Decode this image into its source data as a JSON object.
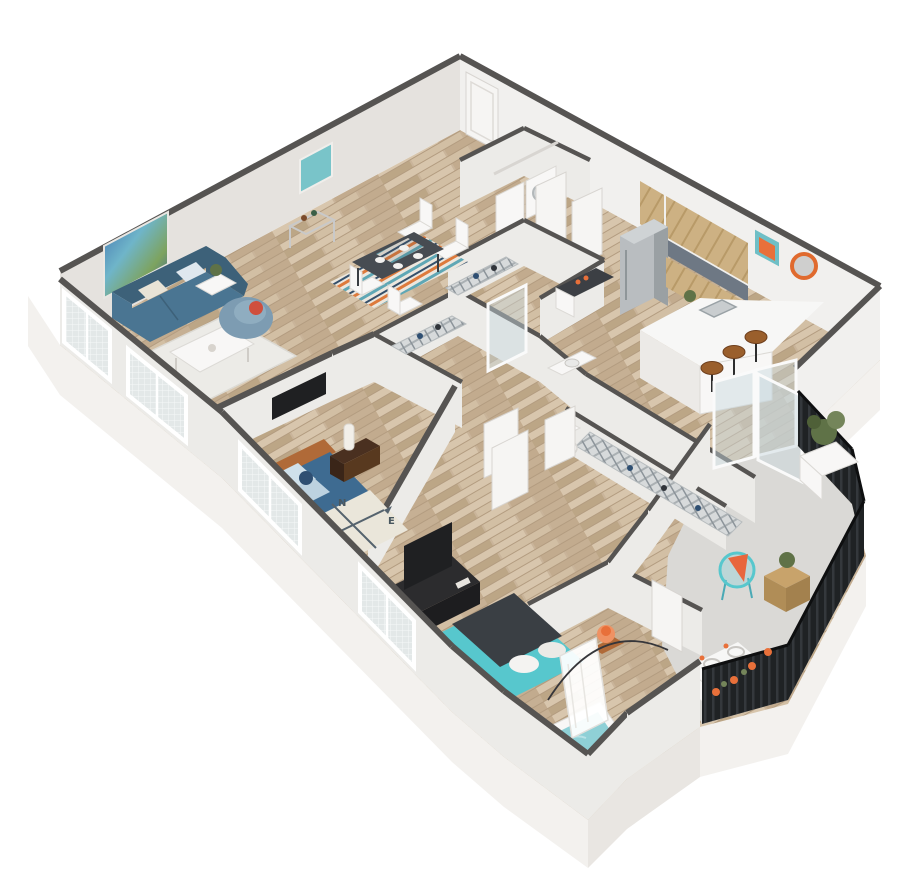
{
  "scene": {
    "type": "3d-isometric-floor-plan",
    "description": "Two-bedroom, two-bathroom apartment floor plan rendered in 3D cutaway perspective with private balcony",
    "compass_blanket": {
      "n": "N",
      "e": "E",
      "s": "S",
      "w": "W"
    },
    "rooms": [
      {
        "id": "living-room",
        "name": "Living Room",
        "furniture": [
          "blue sofa with pillows",
          "white coffee table",
          "blue armchair with red pillow",
          "two ottomans",
          "two side tables with plants",
          "abstract wall art",
          "white area rug"
        ]
      },
      {
        "id": "dining-area",
        "name": "Dining Area",
        "furniture": [
          "dark dining table",
          "four white chairs",
          "striped area rug",
          "bar cart"
        ]
      },
      {
        "id": "kitchen",
        "name": "Kitchen",
        "furniture": [
          "stainless refrigerator",
          "wood upper cabinets",
          "wood lower cabinets",
          "white peninsula counter with sink",
          "three wood bar stools",
          "framed art",
          "round orange mirror"
        ]
      },
      {
        "id": "laundry",
        "name": "Laundry Closet",
        "furniture": [
          "washer",
          "dryer",
          "storage shelf",
          "double doors"
        ]
      },
      {
        "id": "bathroom-1",
        "name": "Bathroom 1",
        "furniture": [
          "glass walk-in shower",
          "dark-top vanity",
          "toilet"
        ]
      },
      {
        "id": "closets",
        "name": "Walk-in Closets",
        "furniture": [
          "wire shelving with clothes"
        ]
      },
      {
        "id": "bedroom-1",
        "name": "Bedroom 1",
        "furniture": [
          "blue bed with compass blanket",
          "wood headboard",
          "nightstand with white lamp",
          "wall TV"
        ]
      },
      {
        "id": "bedroom-2",
        "name": "Bedroom 2",
        "furniture": [
          "teal bed with charcoal blanket",
          "media console with TV",
          "nightstands with orange lamps"
        ]
      },
      {
        "id": "bathroom-2",
        "name": "Bathroom 2",
        "furniture": [
          "bathtub with shower curtain",
          "toilet",
          "double-sink vanity"
        ]
      },
      {
        "id": "balcony",
        "name": "Balcony",
        "furniture": [
          "teal wire chair with orange cushion",
          "wood cube side table",
          "corner planter",
          "orange flowers",
          "dark slat railing",
          "sliding glass door"
        ]
      }
    ]
  },
  "palette": {
    "base_white": "#f3f1ee",
    "base_shade": "#e9e6e2",
    "wall_face": "#ecebe8",
    "wall_nw": "#e5e2de",
    "wall_ne": "#f1f0ee",
    "wall_cap": "#565452",
    "floor_wood": "#c9b49a",
    "floor_wood_light": "#d8c6ad",
    "floor_wood_dark": "#b39c80",
    "balcony_floor": "#dad9d6",
    "door_white": "#f6f5f3",
    "sofa_blue": "#4a7592",
    "sofa_blue_dark": "#3d6179",
    "armchair_blue": "#7d9cb2",
    "bed1_blue": "#3e6b91",
    "accent_teal": "#57c7cd",
    "bed2_blanket": "#3a3f44",
    "headboard_wood": "#b06a38",
    "nightstand_wood": "#4a3020",
    "cabinet_wood": "#cdb183",
    "stool_wood": "#9a5f2c",
    "counter_white": "#f7f7f6",
    "rug_white": "#ecebe7",
    "steel": "#b9bdc0",
    "orange": "#e8703a",
    "water_teal": "#8fd0d6",
    "plant_green": "#5f7247",
    "tv_dark": "#1f2022",
    "railing_dark": "#202326"
  }
}
